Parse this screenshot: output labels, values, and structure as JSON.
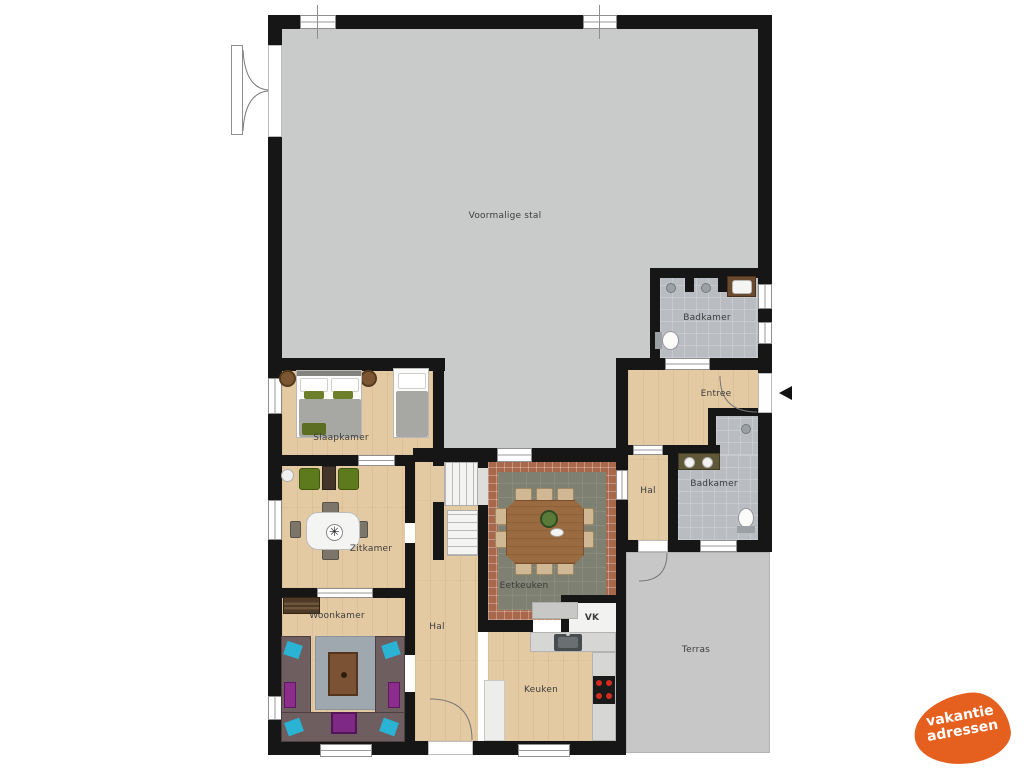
{
  "plan": {
    "rooms": [
      {
        "id": "voormalige-stal",
        "label": "Voormalige stal"
      },
      {
        "id": "badkamer-boven",
        "label": "Badkamer"
      },
      {
        "id": "entree",
        "label": "Entree"
      },
      {
        "id": "hal-rechts",
        "label": "Hal"
      },
      {
        "id": "badkamer-rechts",
        "label": "Badkamer"
      },
      {
        "id": "slaapkamer",
        "label": "Slaapkamer"
      },
      {
        "id": "zitkamer",
        "label": "Zitkamer"
      },
      {
        "id": "woonkamer",
        "label": "Woonkamer"
      },
      {
        "id": "hal",
        "label": "Hal"
      },
      {
        "id": "eetkeuken",
        "label": "Eetkeuken"
      },
      {
        "id": "vk",
        "label": "VK"
      },
      {
        "id": "keuken",
        "label": "Keuken"
      },
      {
        "id": "terras",
        "label": "Terras"
      }
    ],
    "colors": {
      "wall": "#161616",
      "wood_floor": "#e4caa3",
      "stable_floor": "#c9cbca",
      "bathroom_floor": "#b9bdc2",
      "kitchen_tile_center": "#7e8172",
      "kitchen_tile_border": "#a9684c",
      "terrace": "#c6c7c6",
      "label_text": "#3c3c3c",
      "logo_orange": "#e55f1e"
    }
  },
  "logo": {
    "line1": "vakantie",
    "line2": "adressen"
  }
}
